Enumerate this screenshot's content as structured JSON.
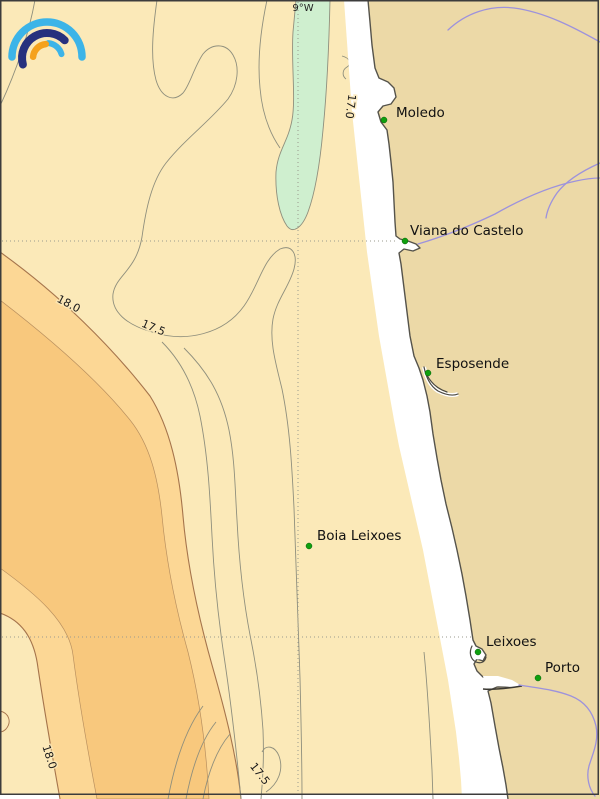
{
  "map": {
    "meridian_label": "9°W",
    "places": [
      {
        "name": "Moledo"
      },
      {
        "name": "Viana do Castelo"
      },
      {
        "name": "Esposende"
      },
      {
        "name": "Boia Leixoes"
      },
      {
        "name": "Leixoes"
      },
      {
        "name": "Porto"
      }
    ],
    "contour_labels": [
      {
        "text": "17.0"
      },
      {
        "text": "18.0"
      },
      {
        "text": "17.5"
      },
      {
        "text": "18.0"
      },
      {
        "text": "17.5"
      }
    ],
    "isotherm_values": [
      "17.0",
      "17.5",
      "18.0"
    ],
    "colors": {
      "sea": "#FBE9B8",
      "land": "#ECD9A7",
      "warm_band": "#FCD795",
      "warm_core": "#F8C87D",
      "cold_band": "#CFEFCF",
      "nearshore_strip": "#FFFFFF",
      "contour": "#8F8F7D",
      "warm_contour": "#A5744C",
      "river": "#9D92DC",
      "grid": "#9A9A8E",
      "marker": "#0FA00F",
      "border": "#3C3C3C",
      "logo_light_blue": "#3CB4E8",
      "logo_navy": "#27317E",
      "logo_orange": "#F5A21D"
    }
  }
}
